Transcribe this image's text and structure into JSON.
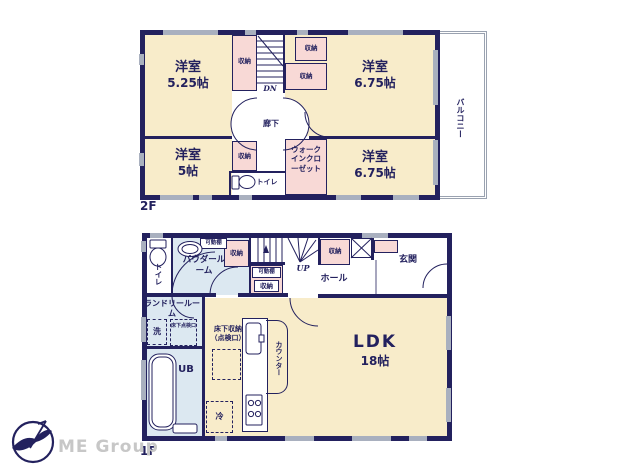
{
  "colors": {
    "wall": "#23215e",
    "room_cream": "#f8ecca",
    "storage_pink": "#f8d9d6",
    "wet_blue": "#dce8f1",
    "window_gray": "#a9b0bf",
    "logo_gray": "#c7c7c7"
  },
  "floor2": {
    "floor_label": "2F",
    "balcony_label": "バルコニー",
    "hallway_label": "廊下",
    "stairs_label": "DN",
    "toilet_label": "トイレ",
    "wic_label": "ウォークインクローゼット",
    "storage_label": "収納",
    "rooms": [
      {
        "name": "洋室",
        "size": "5.25帖"
      },
      {
        "name": "洋室",
        "size": "6.75帖"
      },
      {
        "name": "洋室",
        "size": "5帖"
      },
      {
        "name": "洋室",
        "size": "6.75帖"
      }
    ]
  },
  "floor1": {
    "floor_label": "1F",
    "toilet_label": "トイレ",
    "powder_label": "パウダールーム",
    "shelf_label": "可動棚",
    "storage_label": "収納",
    "stairs_label": "UP",
    "hall_label": "ホール",
    "entrance_label": "玄関",
    "laundry_label": "ランドリールーム",
    "washer_label": "洗",
    "inspection_label": "床下点検口",
    "bath_label": "UB",
    "underfloor_storage_line1": "床下収納",
    "underfloor_storage_line2": "（点検口）",
    "fridge_label": "冷",
    "counter_label": "カウンター",
    "ldk_label": "LDK",
    "ldk_size": "18帖"
  },
  "footer": {
    "brand": "ME Group"
  }
}
